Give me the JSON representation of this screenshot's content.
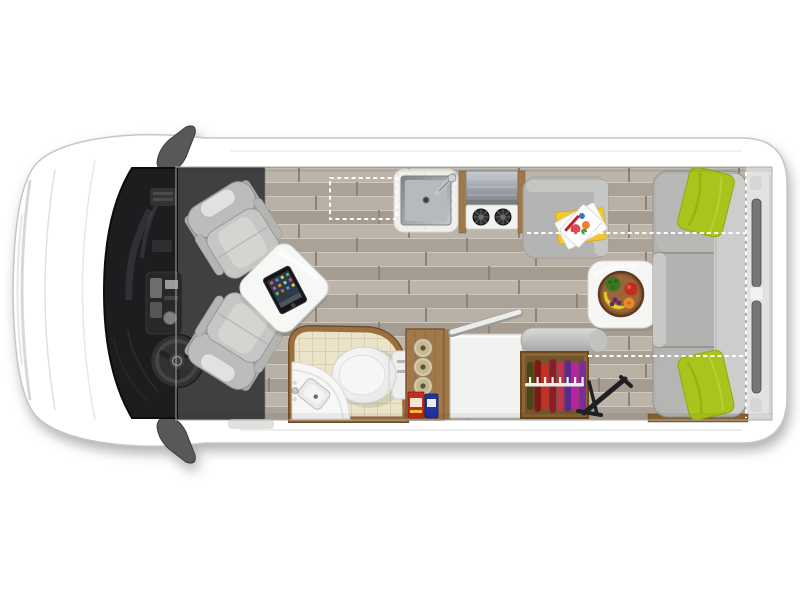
{
  "title": {
    "text": "Play + Slumber"
  },
  "floorplan": {
    "colors": {
      "background": "#ffffff",
      "van_body": "#ffffff",
      "van_outline": "#c6c6c6",
      "mirror": "#58585a",
      "cab_carpet": "#404042",
      "windshield": "#1d1d20",
      "wood_floor": "#b3aaa0",
      "seat": "#c6c6c4",
      "pedestal_table": "#f7f7f6",
      "tablet": "#151517",
      "counter": "#f2f0ea",
      "sink_steel": "#b4babe",
      "cooktop": "#f2f2f0",
      "burner": "#2c2c2e",
      "bench_seat": "#b4b4b2",
      "sofa": "#b2b2b0",
      "sofa_backrest": "#cdcdcb",
      "pillow": "#a8c41d",
      "side_table": "#f6f6f5",
      "fruit_bowl": "#875731",
      "bathroom_tile": "#ebe4ca",
      "bathroom_trim": "#9b6f42",
      "toilet": "#eeeeec",
      "pantry_wood": "#a0784a",
      "cabinet": "#f2f2f0",
      "wardrobe_wood": "#8a6536",
      "rear_door": "#77777a",
      "dashed_marker": "#ffffff"
    },
    "clothes_colors": [
      "#4a4512",
      "#7e1a16",
      "#c43026",
      "#8e1a2e",
      "#c2344e",
      "#5e2a8e",
      "#b822a6",
      "#7c2a9e"
    ]
  }
}
